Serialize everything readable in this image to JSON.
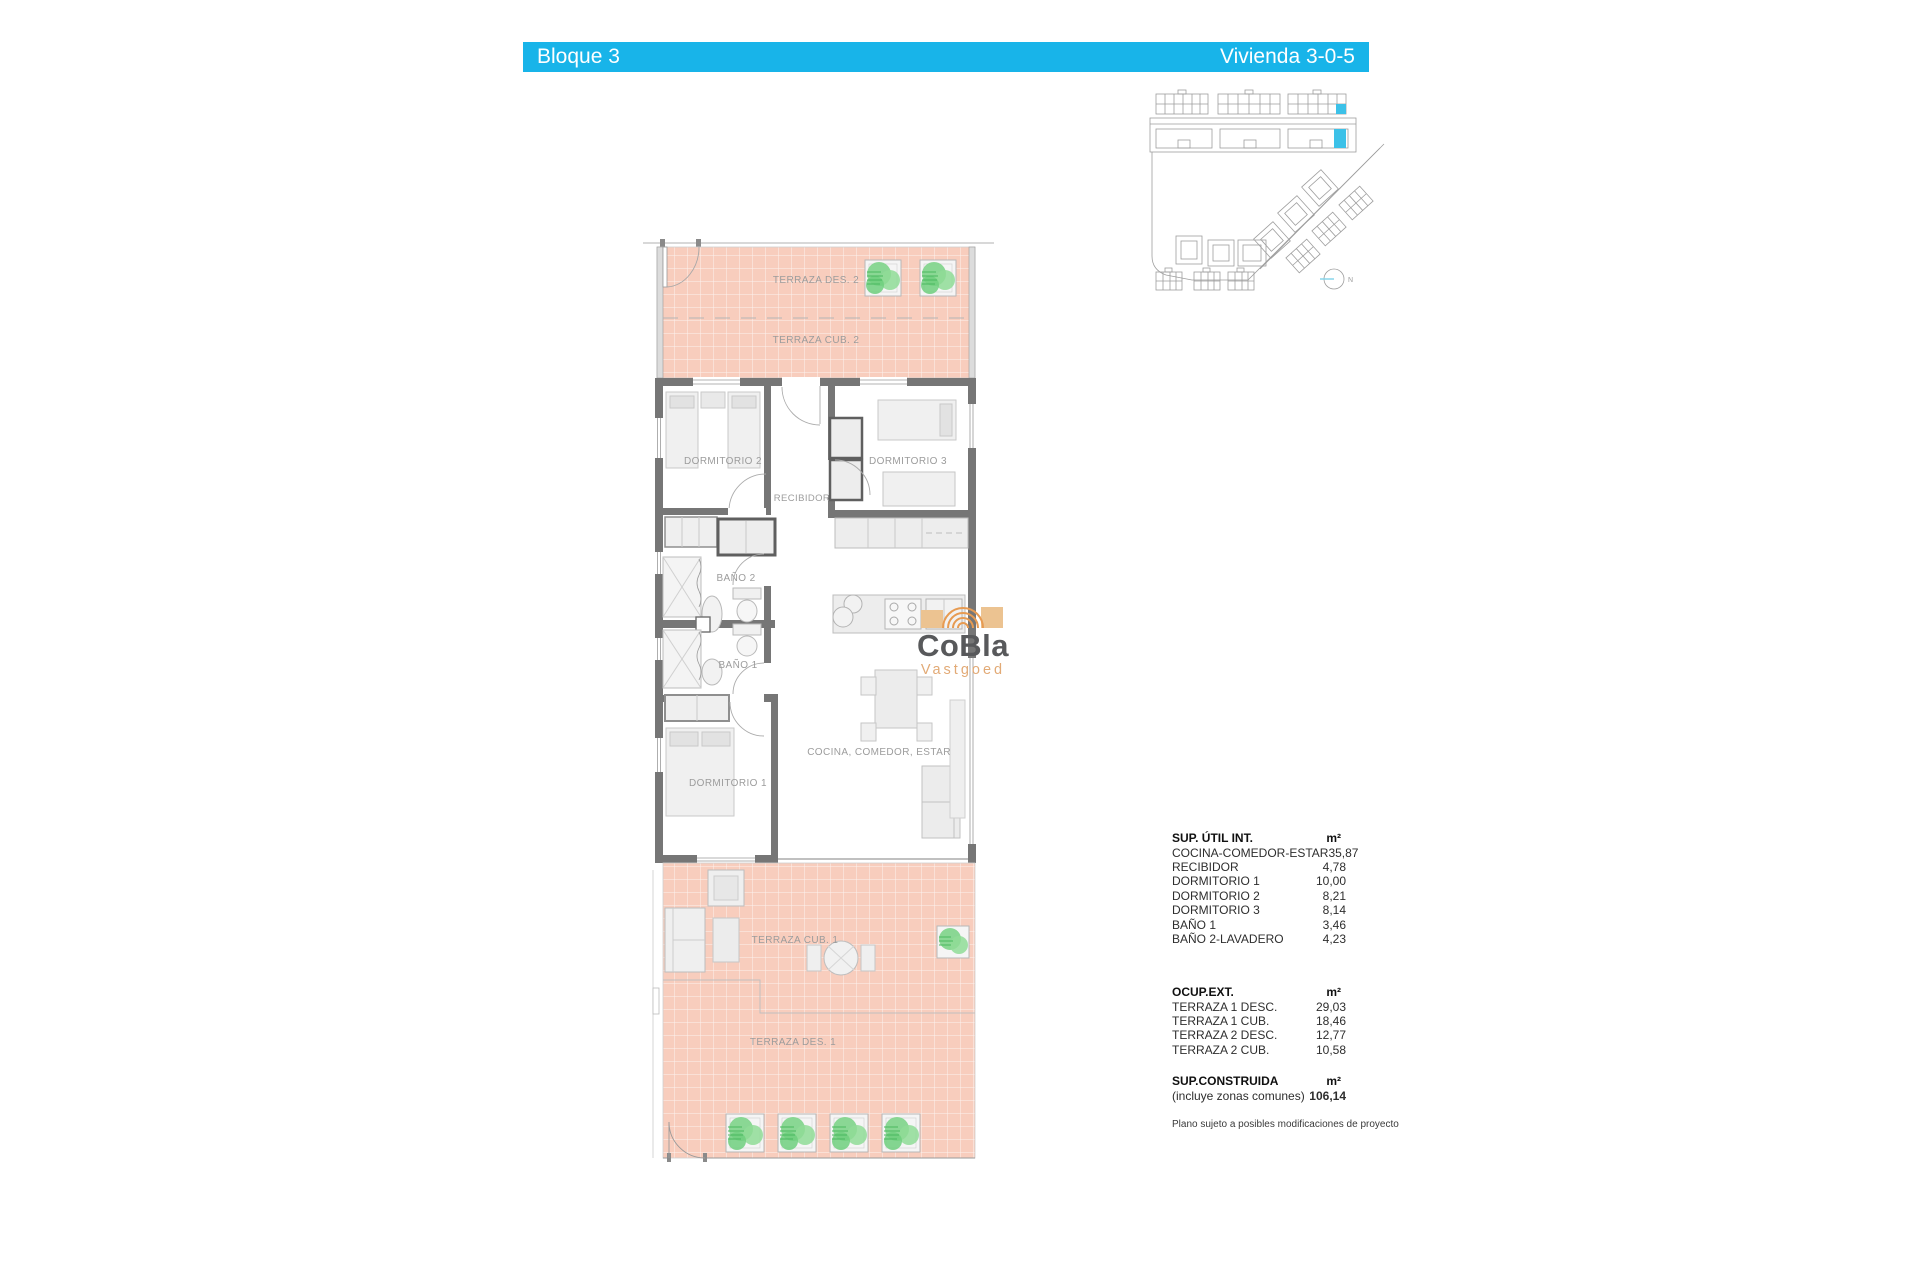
{
  "header": {
    "left_label": "Bloque 3",
    "right_label": "Vivienda 3-0-5",
    "bar_color": "#18b4e9",
    "text_color": "#ffffff"
  },
  "site_plan": {
    "compass_label": "N",
    "highlight_color": "#3cc1e8",
    "line_color": "#9e9e9e"
  },
  "floor_plan": {
    "rooms": {
      "terraza_des_2": "TERRAZA DES. 2",
      "terraza_cub_2": "TERRAZA CUB. 2",
      "dormitorio_2": "DORMITORIO 2",
      "dormitorio_3": "DORMITORIO 3",
      "recibidor": "RECIBIDOR",
      "bano_2": "BAÑO 2",
      "bano_1": "BAÑO 1",
      "cocina_comedor_estar": "COCINA, COMEDOR, ESTAR",
      "dormitorio_1": "DORMITORIO 1",
      "terraza_cub_1": "TERRAZA CUB. 1",
      "terraza_des_1": "TERRAZA DES. 1"
    },
    "colors": {
      "terrace_fill": "#f8cdbd",
      "terrace_grid": "#ffffff",
      "wall": "#767676",
      "furniture_fill": "#efefef",
      "furniture_line": "#c0c0c0",
      "plant_green": "#7ed48a",
      "label_text": "#9c9c9c"
    }
  },
  "watermark": {
    "line1": "CoBla",
    "line2": "Vastgoed",
    "line1_color": "#58595b",
    "line2_color": "#e2aa76",
    "logo_tan": "#ecc391",
    "logo_orange": "#e79b52"
  },
  "areas_table": {
    "sections": [
      {
        "title": "SUP. ÚTIL INT.",
        "unit": "m²",
        "rows": [
          {
            "label": "COCINA-COMEDOR-ESTAR",
            "value": "35,87"
          },
          {
            "label": "RECIBIDOR",
            "value": "4,78"
          },
          {
            "label": "DORMITORIO 1",
            "value": "10,00"
          },
          {
            "label": "DORMITORIO 2",
            "value": "8,21"
          },
          {
            "label": "DORMITORIO 3",
            "value": "8,14"
          },
          {
            "label": "BAÑO 1",
            "value": "3,46"
          },
          {
            "label": "BAÑO 2-LAVADERO",
            "value": "4,23"
          }
        ]
      },
      {
        "title": "OCUP.EXT.",
        "unit": "m²",
        "rows": [
          {
            "label": "TERRAZA 1 DESC.",
            "value": "29,03"
          },
          {
            "label": "TERRAZA 1 CUB.",
            "value": "18,46"
          },
          {
            "label": "TERRAZA 2 DESC.",
            "value": "12,77"
          },
          {
            "label": "TERRAZA 2 CUB.",
            "value": "10,58"
          }
        ]
      },
      {
        "title": "SUP.CONSTRUIDA",
        "unit": "m²",
        "rows": [
          {
            "label": "(incluye zonas comunes)",
            "value": "106,14"
          }
        ]
      }
    ],
    "footnote": "Plano sujeto a posibles modificaciones de proyecto"
  }
}
